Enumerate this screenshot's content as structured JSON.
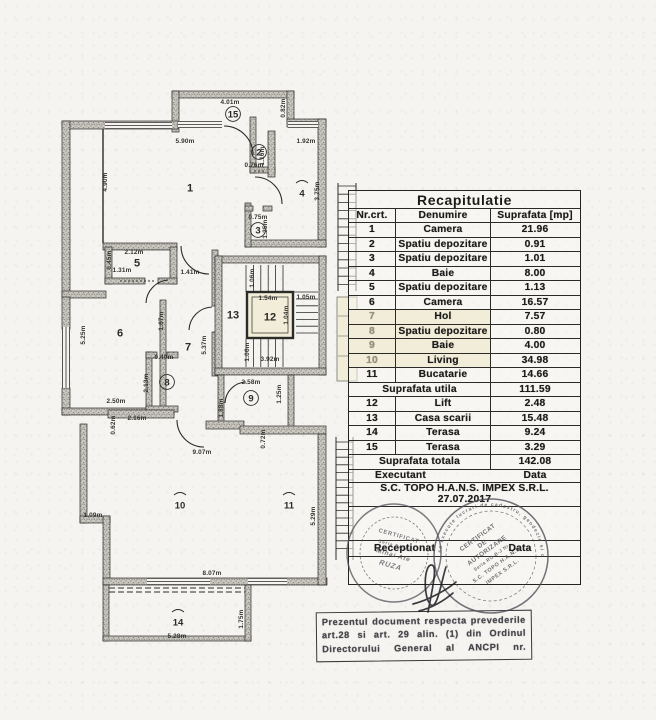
{
  "paper": {
    "bg": "#f5f4f1",
    "ink": "#2b2b28",
    "wall_fill": "#c9c7c0",
    "wall_dot": "#87857d",
    "cream": "#f2edd8",
    "stamp_ink": "#4c4c55"
  },
  "table": {
    "title": "Recapitulatie",
    "columns": [
      "Nr.crt.",
      "Denumire",
      "Suprafata [mp]"
    ],
    "rows": [
      [
        "1",
        "Camera",
        "21.96"
      ],
      [
        "2",
        "Spatiu depozitare",
        "0.91"
      ],
      [
        "3",
        "Spatiu depozitare",
        "1.01"
      ],
      [
        "4",
        "Baie",
        "8.00"
      ],
      [
        "5",
        "Spatiu depozitare",
        "1.13"
      ],
      [
        "6",
        "Camera",
        "16.57"
      ],
      [
        "7",
        "Hol",
        "7.57"
      ],
      [
        "8",
        "Spatiu depozitare",
        "0.80"
      ],
      [
        "9",
        "Baie",
        "4.00"
      ],
      [
        "10",
        "Living",
        "34.98"
      ],
      [
        "11",
        "Bucatarie",
        "14.66"
      ]
    ],
    "faded_rows": [
      "7",
      "8",
      "9",
      "10"
    ],
    "subtotal": {
      "label": "Suprafata utila",
      "value": "111.59"
    },
    "rows2": [
      [
        "12",
        "Lift",
        "2.48"
      ],
      [
        "13",
        "Casa scarii",
        "15.48"
      ],
      [
        "14",
        "Terasa",
        "9.24"
      ],
      [
        "15",
        "Terasa",
        "3.29"
      ]
    ],
    "total": {
      "label": "Suprafata totala",
      "value": "142.08"
    },
    "executant_label": "Executant",
    "executant_data_label": "Data",
    "executant_name": "S.C. TOPO H.A.N.S. IMPEX S.R.L.",
    "date": "27.07.2017",
    "receptionat_label": "Receptionat",
    "receptionat_data_label": "Data"
  },
  "plan": {
    "rooms": [
      {
        "n": "1",
        "x": 190,
        "y": 188,
        "s": "plain"
      },
      {
        "n": "2",
        "x": 259,
        "y": 152,
        "s": "circle"
      },
      {
        "n": "3",
        "x": 258,
        "y": 230,
        "s": "circle"
      },
      {
        "n": "4",
        "x": 302,
        "y": 193,
        "s": "arc"
      },
      {
        "n": "5",
        "x": 137,
        "y": 263,
        "s": "plain"
      },
      {
        "n": "6",
        "x": 120,
        "y": 333,
        "s": "plain"
      },
      {
        "n": "7",
        "x": 188,
        "y": 347,
        "s": "plain"
      },
      {
        "n": "8",
        "x": 167,
        "y": 382,
        "s": "circle"
      },
      {
        "n": "9",
        "x": 251,
        "y": 398,
        "s": "circle"
      },
      {
        "n": "10",
        "x": 180,
        "y": 505,
        "s": "arc"
      },
      {
        "n": "11",
        "x": 289,
        "y": 505,
        "s": "arc"
      },
      {
        "n": "12",
        "x": 270,
        "y": 317,
        "s": "plain"
      },
      {
        "n": "13",
        "x": 233,
        "y": 315,
        "s": "plain"
      },
      {
        "n": "14",
        "x": 178,
        "y": 622,
        "s": "arc"
      },
      {
        "n": "15",
        "x": 233,
        "y": 114,
        "s": "circle"
      }
    ],
    "dims": [
      {
        "t": "4.01m",
        "x": 230,
        "y": 104,
        "r": 0
      },
      {
        "t": "5.90m",
        "x": 185,
        "y": 143,
        "r": 0
      },
      {
        "t": "1.92m",
        "x": 306,
        "y": 143,
        "r": 0
      },
      {
        "t": "0.76m",
        "x": 254,
        "y": 167,
        "r": 0
      },
      {
        "t": "0.75m",
        "x": 258,
        "y": 219,
        "r": 0
      },
      {
        "t": "2.12m",
        "x": 134,
        "y": 254,
        "r": 0
      },
      {
        "t": "1.31m",
        "x": 122,
        "y": 272,
        "r": 0
      },
      {
        "t": "1.41m",
        "x": 190,
        "y": 274,
        "r": 0
      },
      {
        "t": "1.54m",
        "x": 268,
        "y": 300,
        "r": 0
      },
      {
        "t": "1.05m",
        "x": 306,
        "y": 299,
        "r": 0
      },
      {
        "t": "3.92m",
        "x": 270,
        "y": 361,
        "r": 0
      },
      {
        "t": "2.58m",
        "x": 251,
        "y": 384,
        "r": 0
      },
      {
        "t": "2.50m",
        "x": 116,
        "y": 403,
        "r": 0
      },
      {
        "t": "2.16m",
        "x": 137,
        "y": 420,
        "r": 0
      },
      {
        "t": "9.07m",
        "x": 202,
        "y": 454,
        "r": 0
      },
      {
        "t": "1.09m",
        "x": 93,
        "y": 517,
        "r": 0
      },
      {
        "t": "8.07m",
        "x": 212,
        "y": 575,
        "r": 0
      },
      {
        "t": "5.28m",
        "x": 177,
        "y": 638,
        "r": 0
      },
      {
        "t": "0.40m",
        "x": 164,
        "y": 359,
        "r": 0
      },
      {
        "t": "0.82m",
        "x": 285,
        "y": 108,
        "r": -90
      },
      {
        "t": "4.90m",
        "x": 107,
        "y": 182,
        "r": -90
      },
      {
        "t": "3.75m",
        "x": 319,
        "y": 191,
        "r": -90
      },
      {
        "t": "1.16m",
        "x": 264,
        "y": 156,
        "r": -90
      },
      {
        "t": "1.25m",
        "x": 267,
        "y": 229,
        "r": -90
      },
      {
        "t": "0.45m",
        "x": 111,
        "y": 260,
        "r": -90
      },
      {
        "t": "5.25m",
        "x": 85,
        "y": 335,
        "r": -90
      },
      {
        "t": "1.67m",
        "x": 163,
        "y": 321,
        "r": -90
      },
      {
        "t": "5.37m",
        "x": 206,
        "y": 345,
        "r": -90
      },
      {
        "t": "1.06m",
        "x": 254,
        "y": 278,
        "r": -90
      },
      {
        "t": "1.04m",
        "x": 288,
        "y": 315,
        "r": -90
      },
      {
        "t": "1.06m",
        "x": 249,
        "y": 352,
        "r": -90
      },
      {
        "t": "2.13m",
        "x": 148,
        "y": 383,
        "r": -90
      },
      {
        "t": "1.25m",
        "x": 281,
        "y": 394,
        "r": -90
      },
      {
        "t": "1.88m",
        "x": 223,
        "y": 408,
        "r": -90
      },
      {
        "t": "0.62m",
        "x": 115,
        "y": 425,
        "r": -90
      },
      {
        "t": "0.72m",
        "x": 265,
        "y": 439,
        "r": -90
      },
      {
        "t": "5.29m",
        "x": 315,
        "y": 516,
        "r": -90
      },
      {
        "t": "1.75m",
        "x": 243,
        "y": 619,
        "r": -90
      }
    ]
  },
  "stamps": {
    "left": {
      "lines": [
        "CERTIFICAT",
        "Seria RO Nr.",
        "Mihai Ate",
        "RUZA"
      ]
    },
    "right": {
      "ring": "sa execute lucrari de cadastru, geodezie si cartografie",
      "lines": [
        "CERTIFICAT",
        "DE",
        "AUTORIZARE",
        "Seria RO-B-J Nr.",
        "S.C. TOPO H.A.N.S.",
        "IMPEX S.R.L."
      ]
    }
  },
  "note": {
    "lines": [
      "Prezentul document respecta prevederile",
      "art.28 si art. 29 alin. (1) din Ordinul",
      "Directorului General al ANCPI nr."
    ]
  }
}
